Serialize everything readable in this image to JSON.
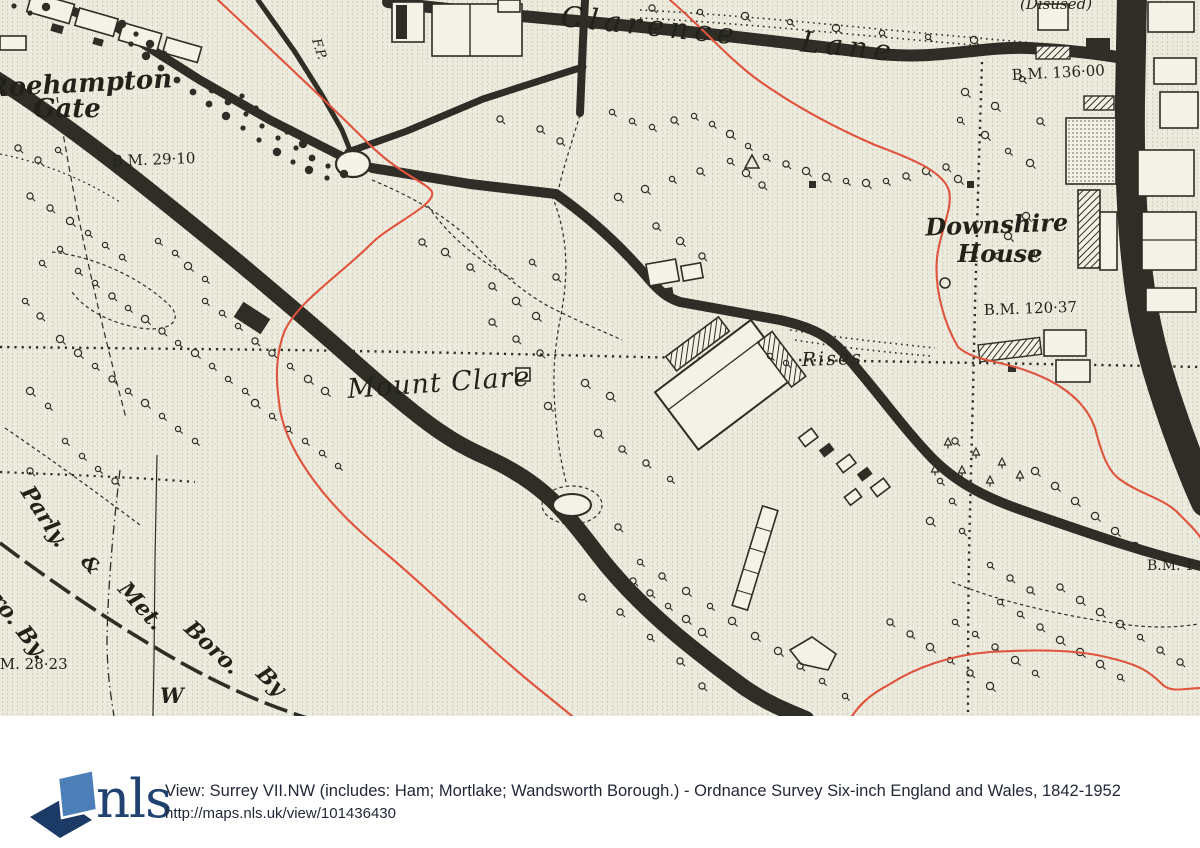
{
  "map": {
    "labels": {
      "roehampton": "Roehampton",
      "gate": "Gate",
      "bm_29": "B.M. 29·10",
      "clarence_lane": "Clarence Lane",
      "fp": "F.P.",
      "disused": "(Disused)",
      "bm_136": "B.M. 136·00",
      "downshire": "Downshire",
      "house": "House",
      "bm_120": "B.M. 120·37",
      "mount_clare": "Mount Clare",
      "rises": "Rises",
      "bm_edge": "B.M. 1",
      "parly": "Parly.",
      "amp": "&",
      "ro_by": "ro. By.",
      "met": "Met.",
      "boro": "Boro.",
      "by": "By",
      "w": "W",
      "bm_28": "B.M. 28·23"
    },
    "colors": {
      "paper": "#edebdd",
      "ink": "#2e2d26",
      "boundary_red": "#e0543e"
    }
  },
  "footer": {
    "brand": "nls",
    "title": "View: Surrey VII.NW (includes: Ham; Mortlake; Wandsworth Borough.) - Ordnance Survey Six-inch England and Wales, 1842-1952",
    "url": "http://maps.nls.uk/view/101436430",
    "logo_colors": {
      "light": "#4c7fb7",
      "dark": "#1c3a66"
    }
  }
}
